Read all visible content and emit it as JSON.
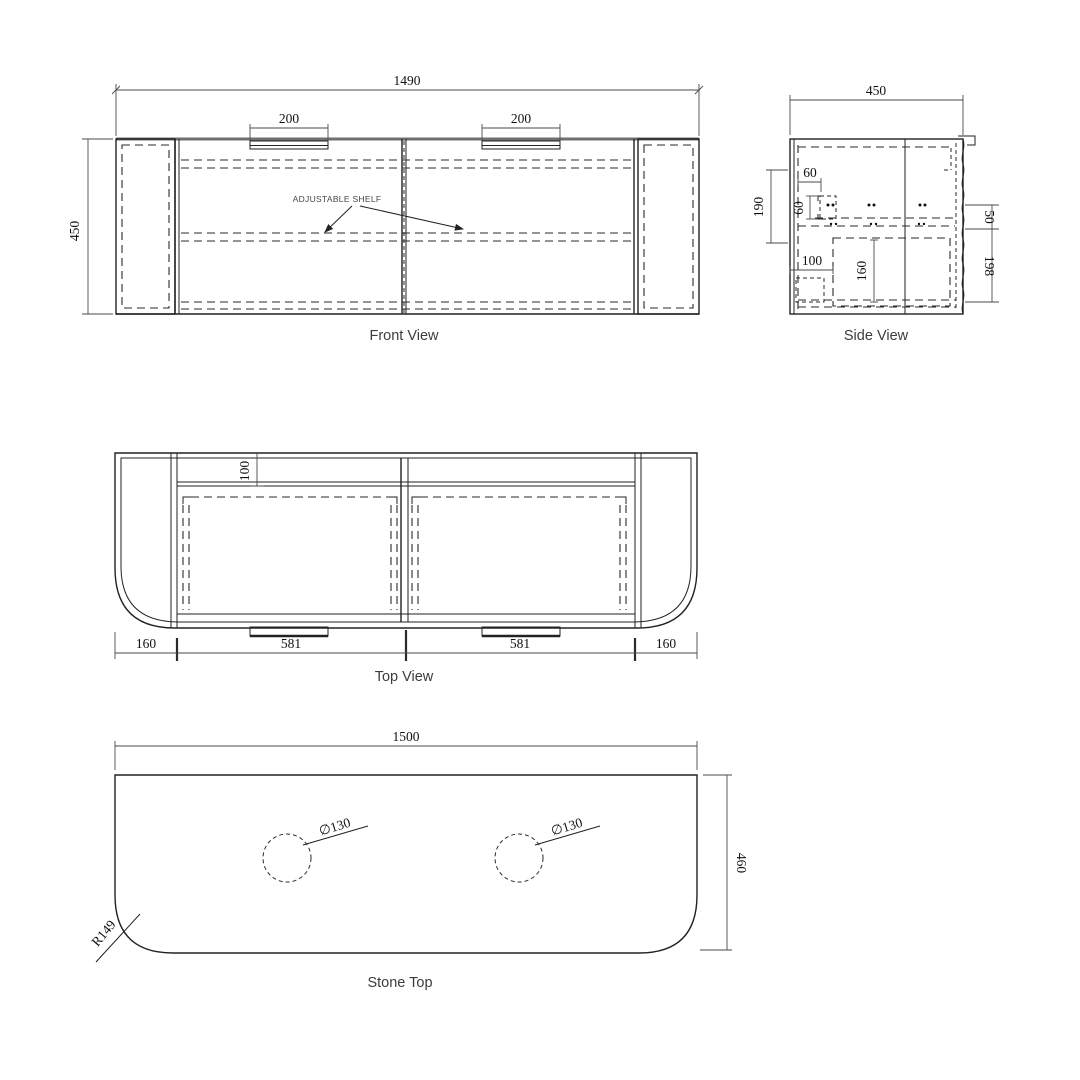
{
  "front_view": {
    "label": "Front View",
    "note": "ADJUSTABLE SHELF",
    "dim_width": "1490",
    "dim_height": "450",
    "dim_handle_left": "200",
    "dim_handle_right": "200"
  },
  "side_view": {
    "label": "Side View",
    "dim_depth": "450",
    "dim_190": "190",
    "dim_60_h": "60",
    "dim_60_v": "60",
    "dim_100": "100",
    "dim_160": "160",
    "dim_50": "50",
    "dim_198": "198"
  },
  "top_view": {
    "label": "Top View",
    "dim_100": "100",
    "dim_end_left": "160",
    "dim_door_left": "581",
    "dim_door_right": "581",
    "dim_end_right": "160"
  },
  "stone_top": {
    "label": "Stone Top",
    "dim_width": "1500",
    "dim_depth": "460",
    "dim_hole_left": "∅130",
    "dim_hole_right": "∅130",
    "dim_radius": "R149"
  }
}
